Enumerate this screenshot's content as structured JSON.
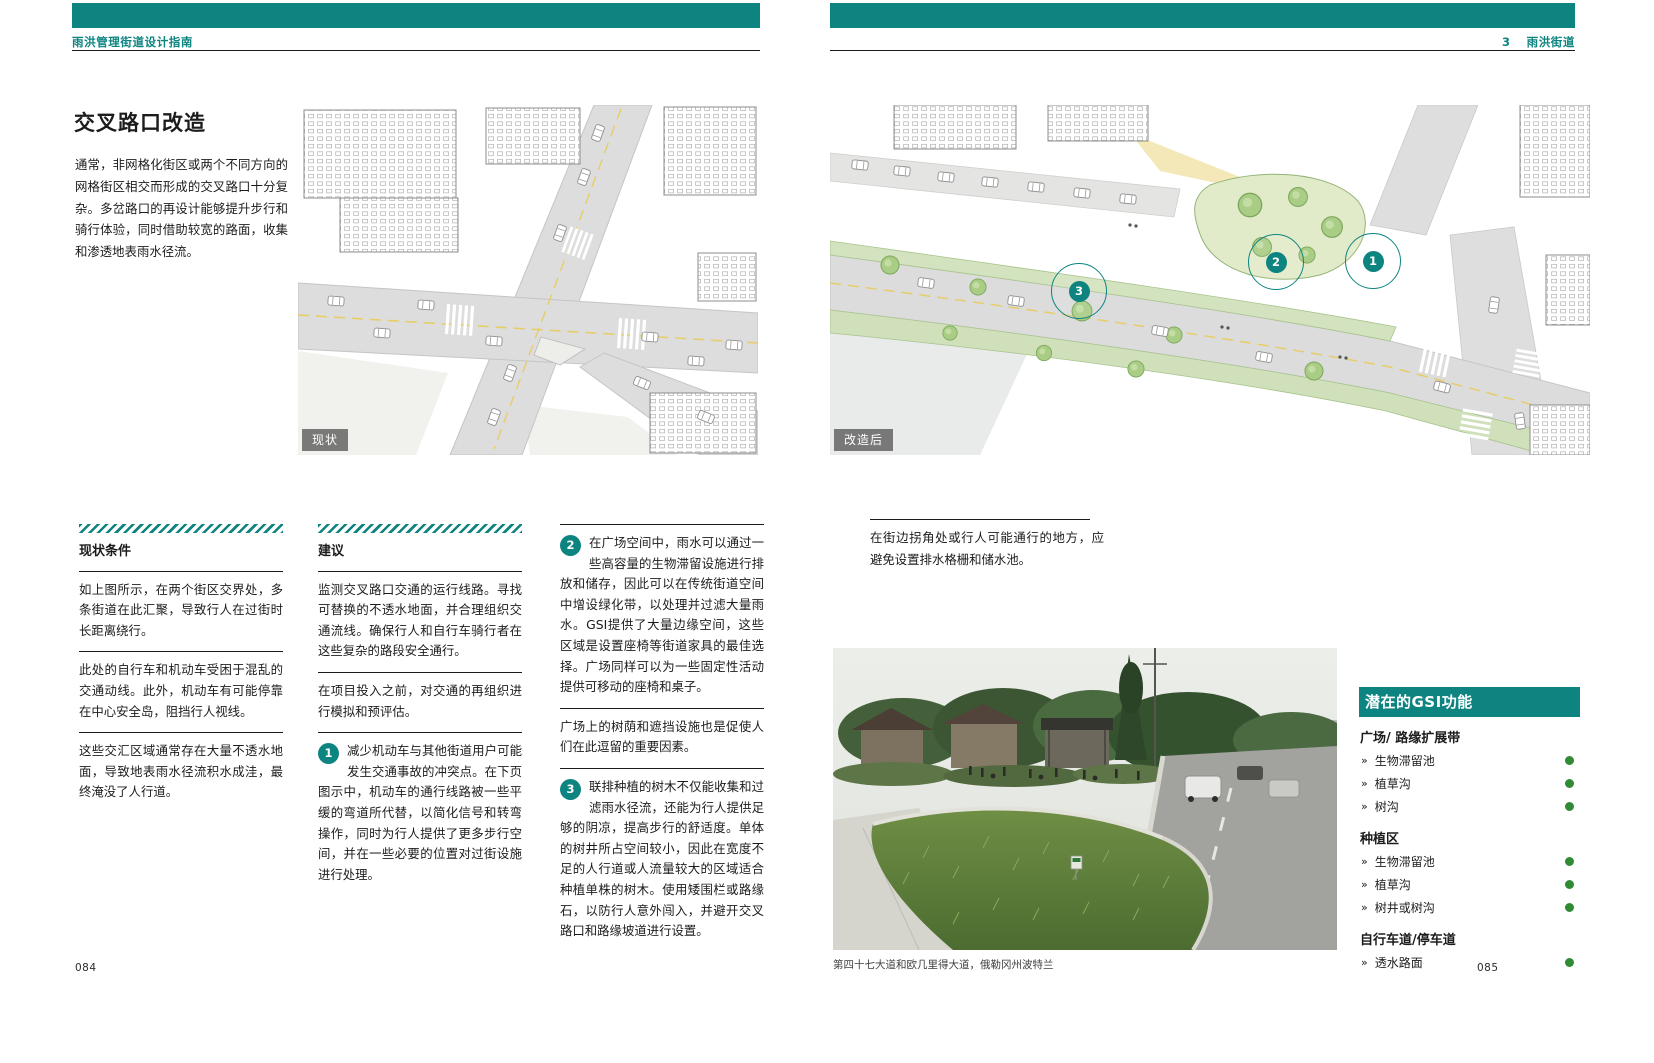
{
  "meta": {
    "left_header": "雨洪管理街道设计指南",
    "right_header_num": "3",
    "right_header_title": "雨洪街道",
    "left_page_number": "084",
    "right_page_number": "085"
  },
  "left": {
    "title": "交叉路口改造",
    "intro": "通常，非网格化街区或两个不同方向的网格街区相交而形成的交叉路口十分复杂。多岔路口的再设计能够提升步行和骑行体验，同时借助较宽的路面，收集和渗透地表雨水径流。",
    "figure_label": "现状",
    "conditions": {
      "heading": "现状条件",
      "p1": "如上图所示，在两个街区交界处，多条街道在此汇聚，导致行人在过街时长距离绕行。",
      "p2": "此处的自行车和机动车受困于混乱的交通动线。此外，机动车有可能停靠在中心安全岛，阻挡行人视线。",
      "p3": "这些交汇区域通常存在大量不透水地面，导致地表雨水径流积水成洼，最终淹没了人行道。"
    },
    "recommendations": {
      "heading": "建议",
      "p1": "监测交叉路口交通的运行线路。寻找可替换的不透水地面，并合理组织交通流线。确保行人和自行车骑行者在这些复杂的路段安全通行。",
      "p2": "在项目投入之前，对交通的再组织进行模拟和预评估。",
      "item1_num": "1",
      "item1": "减少机动车与其他街道用户可能发生交通事故的冲突点。在下页图示中，机动车的通行线路被一些平缓的弯道所代替，以简化信号和转弯操作，同时为行人提供了更多步行空间，并在一些必要的位置对过街设施进行处理。"
    },
    "col3": {
      "item2_num": "2",
      "item2": "在广场空间中，雨水可以通过一些高容量的生物滞留设施进行排放和储存，因此可以在传统街道空间中增设绿化带，以处理并过滤大量雨水。GSI提供了大量边缘空间，这些区域是设置座椅等街道家具的最佳选择。广场同样可以为一些固定性活动提供可移动的座椅和桌子。",
      "p_mid": "广场上的树荫和遮挡设施也是促使人们在此逗留的重要因素。",
      "item3_num": "3",
      "item3": "联排种植的树木不仅能收集和过滤雨水径流，还能为行人提供足够的阴凉，提高步行的舒适度。单体的树井所占空间较小，因此在宽度不足的人行道或人流量较大的区域适合种植单株的树木。使用矮围栏或路缘石，以防行人意外闯入，并避开交叉路口和路缘坡道进行设置。"
    }
  },
  "right": {
    "figure_label": "改造后",
    "marker1": "1",
    "marker2": "2",
    "marker3": "3",
    "note": "在街边拐角处或行人可能通行的地方，应避免设置排水格栅和储水池。",
    "photo_caption": "第四十七大道和欧几里得大道，俄勒冈州波特兰",
    "sidebar": {
      "title": "潜在的GSI功能",
      "bullet": "»",
      "groups": [
        {
          "heading": "广场/ 路缘扩展带",
          "items": [
            {
              "label": "生物滞留池"
            },
            {
              "label": "植草沟"
            },
            {
              "label": "树沟"
            }
          ]
        },
        {
          "heading": "种植区",
          "items": [
            {
              "label": "生物滞留池"
            },
            {
              "label": "植草沟"
            },
            {
              "label": "树井或树沟"
            }
          ]
        },
        {
          "heading": "自行车道/停车道",
          "items": [
            {
              "label": "透水路面"
            }
          ]
        }
      ]
    }
  },
  "colors": {
    "teal": "#0d8480",
    "green_dot": "#318a34"
  }
}
